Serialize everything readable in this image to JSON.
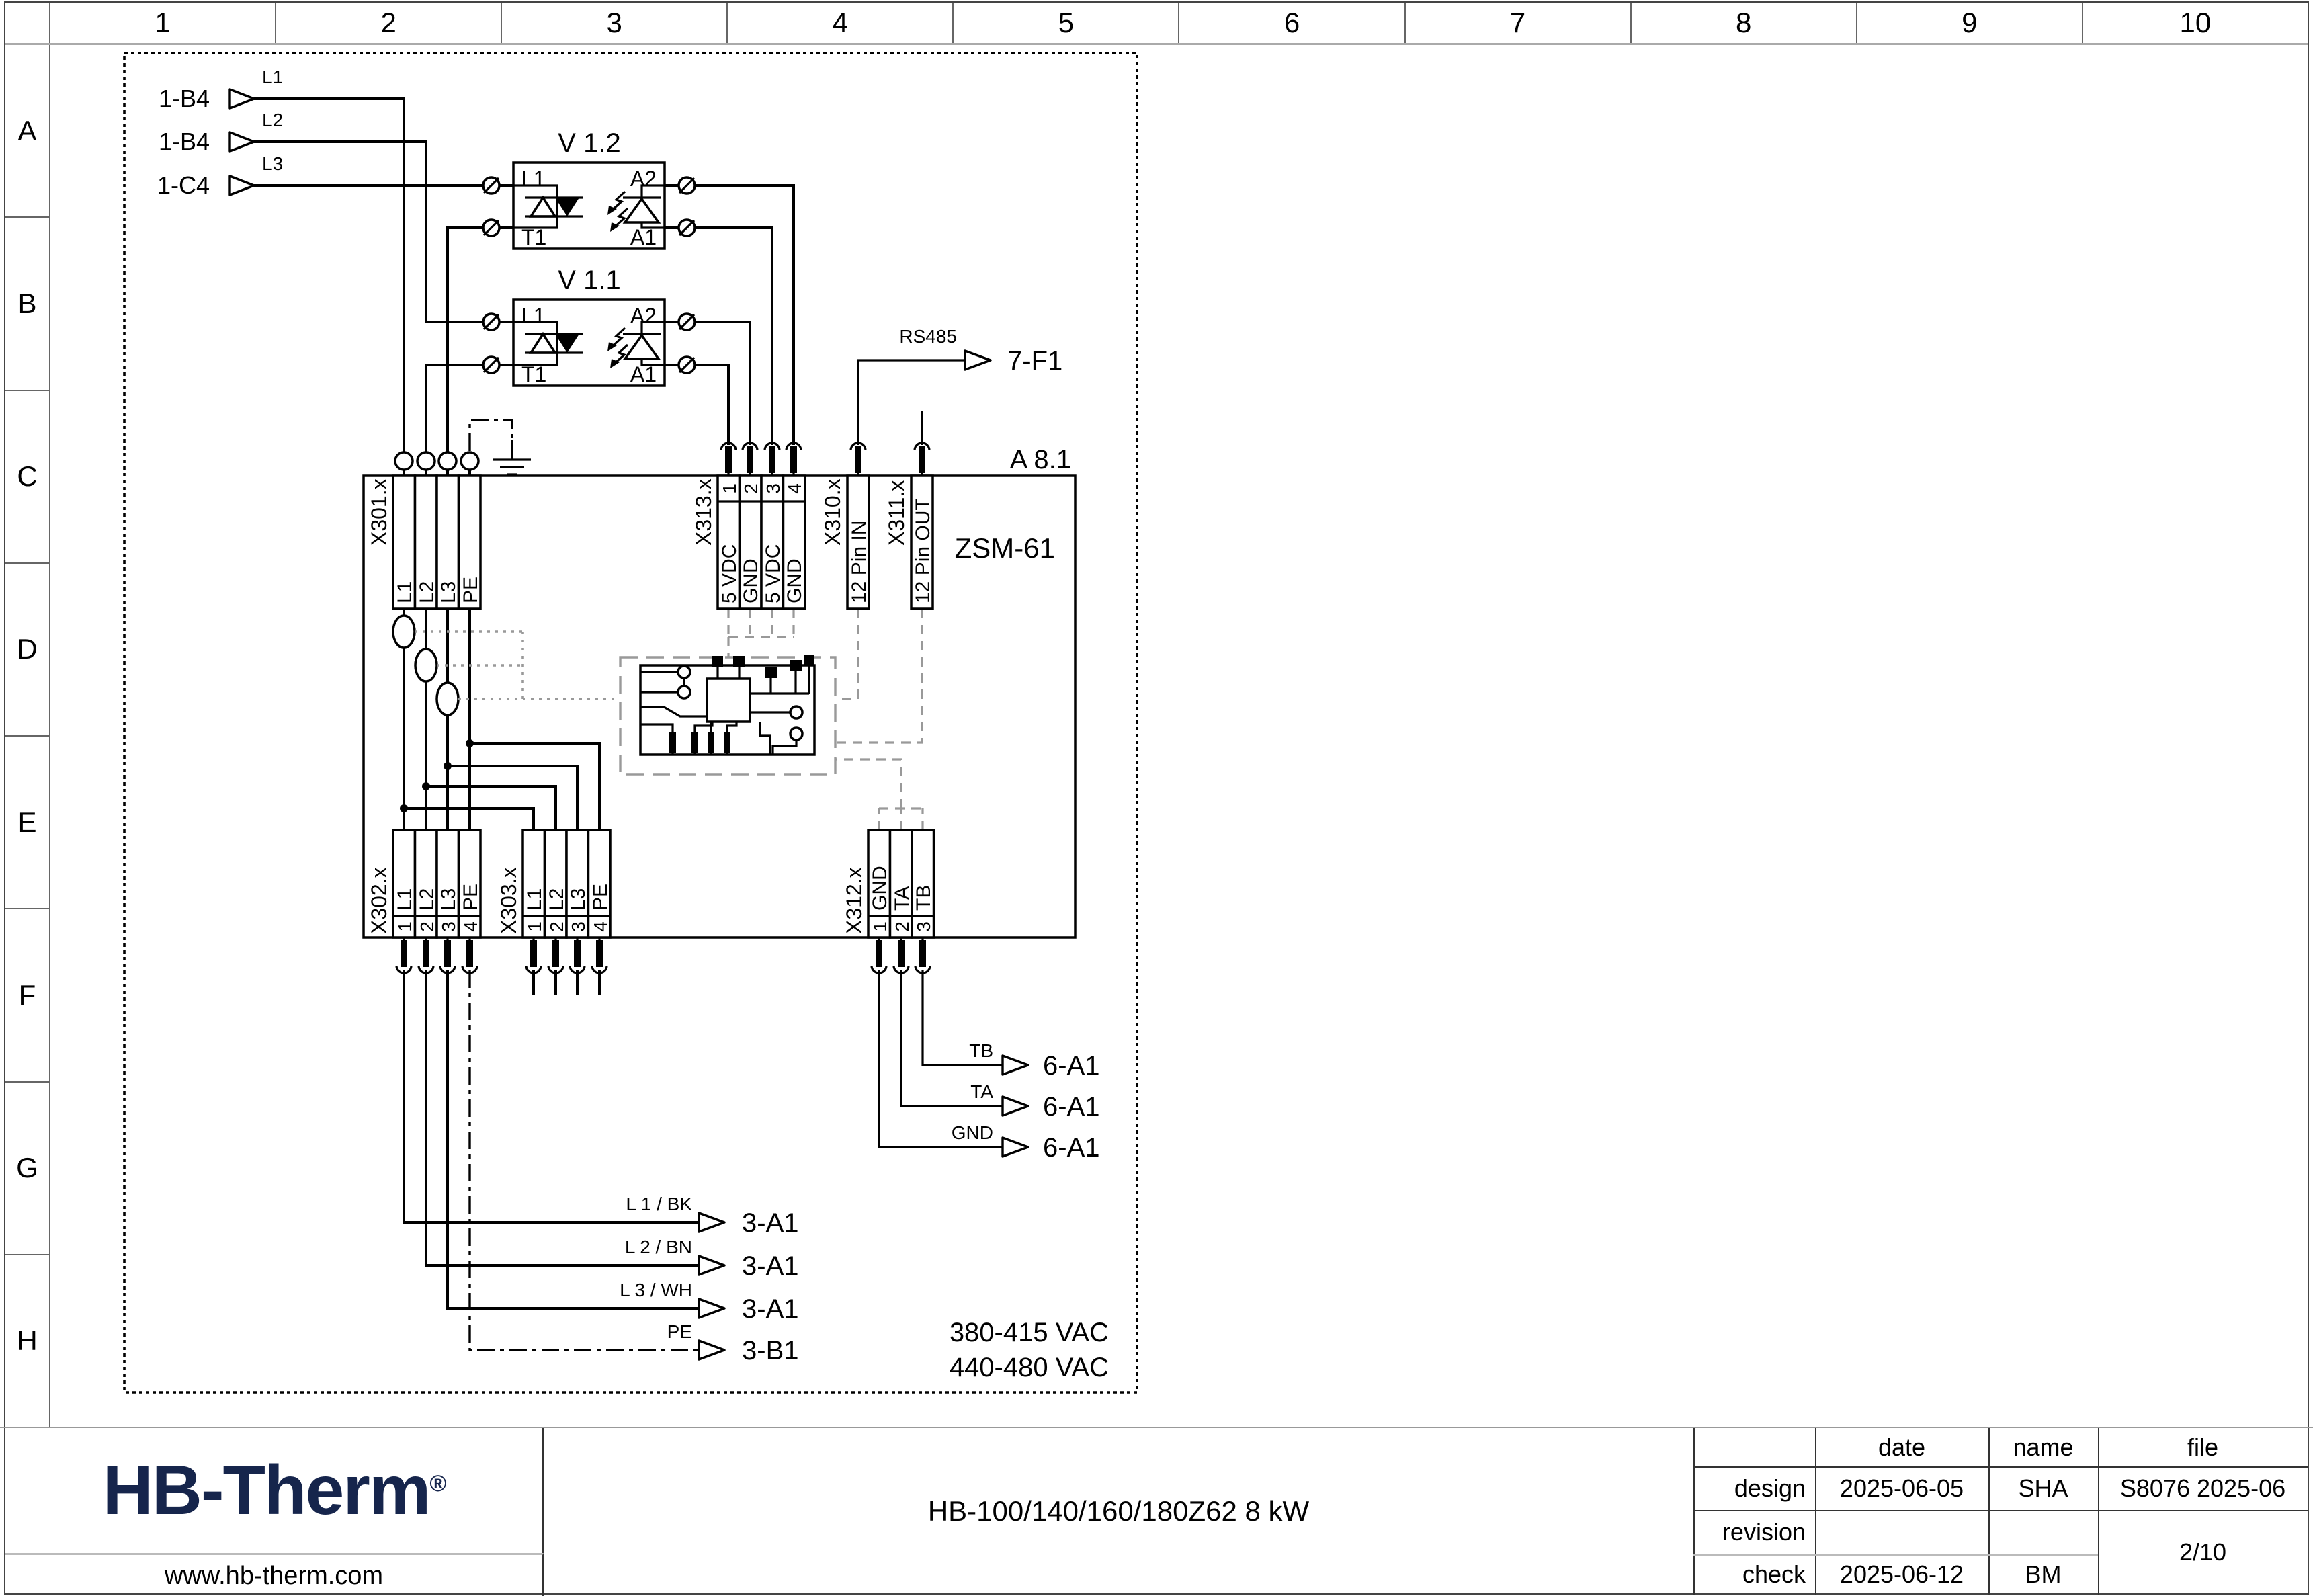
{
  "sheet": {
    "columns": [
      "1",
      "2",
      "3",
      "4",
      "5",
      "6",
      "7",
      "8",
      "9",
      "10"
    ],
    "rows": [
      "A",
      "B",
      "C",
      "D",
      "E",
      "F",
      "G",
      "H"
    ]
  },
  "schematic": {
    "inputs": [
      {
        "ref": "1-B4",
        "phase": "L1"
      },
      {
        "ref": "1-B4",
        "phase": "L2"
      },
      {
        "ref": "1-C4",
        "phase": "L3"
      }
    ],
    "modules": {
      "v12": {
        "title": "V 1.2",
        "l1": "L1",
        "a2": "A2",
        "t1": "T1",
        "a1": "A1"
      },
      "v11": {
        "title": "V 1.1",
        "l1": "L1",
        "a2": "A2",
        "t1": "T1",
        "a1": "A1"
      }
    },
    "board": {
      "ref": "A 8.1",
      "name": "ZSM-61"
    },
    "x301": {
      "label": "X301.x",
      "pins": [
        "L1",
        "L2",
        "L3",
        "PE"
      ]
    },
    "x313": {
      "label": "X313.x",
      "numbers": [
        "1",
        "2",
        "3",
        "4"
      ],
      "pins": [
        "5 VDC",
        "GND",
        "5 VDC",
        "GND"
      ]
    },
    "x310": {
      "label": "X310.x",
      "pin": "12 Pin IN"
    },
    "x311": {
      "label": "X311.x",
      "pin": "12 Pin OUT"
    },
    "x302": {
      "label": "X302.x",
      "numbers": [
        "1",
        "2",
        "3",
        "4"
      ],
      "pins": [
        "L1",
        "L2",
        "L3",
        "PE"
      ]
    },
    "x303": {
      "label": "X303.x",
      "numbers": [
        "1",
        "2",
        "3",
        "4"
      ],
      "pins": [
        "L1",
        "L2",
        "L3",
        "PE"
      ]
    },
    "x312": {
      "label": "X312.x",
      "numbers": [
        "1",
        "2",
        "3"
      ],
      "pins": [
        "GND",
        "TA",
        "TB"
      ]
    },
    "rs485": {
      "label": "RS485",
      "target": "7-F1"
    },
    "right_outputs": [
      {
        "label": "TB",
        "target": "6-A1"
      },
      {
        "label": "TA",
        "target": "6-A1"
      },
      {
        "label": "GND",
        "target": "6-A1"
      }
    ],
    "bottom_outputs": [
      {
        "label": "L 1 / BK",
        "target": "3-A1"
      },
      {
        "label": "L 2 / BN",
        "target": "3-A1"
      },
      {
        "label": "L 3 / WH",
        "target": "3-A1"
      },
      {
        "label": "PE",
        "target": "3-B1"
      }
    ],
    "voltage": [
      "380-415 VAC",
      "440-480 VAC"
    ]
  },
  "title_block": {
    "logo_text": "HB-Therm",
    "logo_reg": "®",
    "logo_color": "#16254c",
    "website": "www.hb-therm.com",
    "doc_title": "HB-100/140/160/180Z62 8 kW",
    "col_date": "date",
    "col_name": "name",
    "col_file": "file",
    "row_design": "design",
    "design_date": "2025-06-05",
    "design_name": "SHA",
    "file_value": "S8076 2025-06",
    "row_revision": "revision",
    "row_check": "check",
    "check_date": "2025-06-12",
    "check_name": "BM",
    "page": "2/10"
  }
}
